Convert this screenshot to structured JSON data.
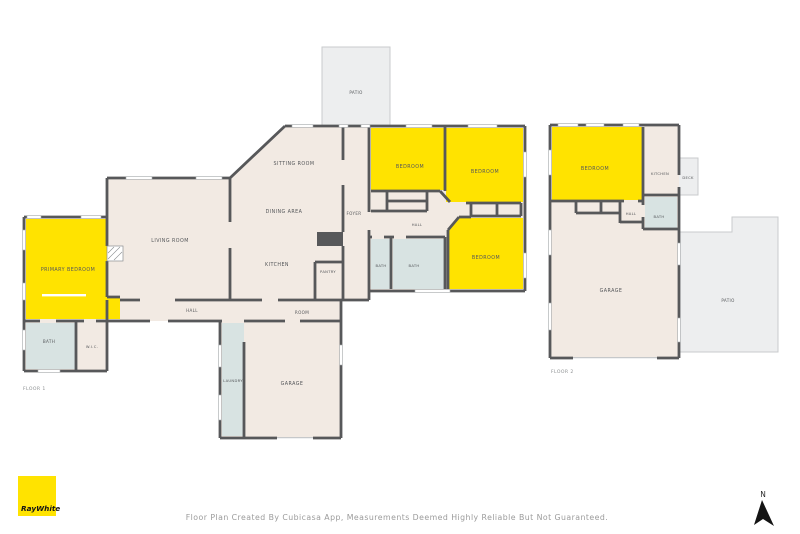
{
  "page": {
    "disclaimer": "Floor Plan Created By Cubicasa App, Measurements Deemed Highly Reliable But Not Guaranteed.",
    "north_label": "N"
  },
  "branding": {
    "logo_text": "RayWhite",
    "logo_color": "#FFE300"
  },
  "palette": {
    "wall": "#57585A",
    "room": "#F2EAE3",
    "wet_room": "#D8E3E2",
    "outdoor": "#EDEEEF",
    "highlight": "#FFE300",
    "label": "#55575A",
    "muted": "#9B9B9B"
  },
  "floor1": {
    "title": "FLOOR 1",
    "rooms": {
      "patio": "PATIO",
      "sitting_room": "SITTING ROOM",
      "dining_area": "DINING AREA",
      "living_room": "LIVING ROOM",
      "kitchen": "KITCHEN",
      "pantry": "PANTRY",
      "foyer": "FOYER",
      "primary_bedroom": "PRIMARY BEDROOM",
      "hall": "HALL",
      "room": "ROOM",
      "bath_master": "BATH",
      "wic": "W.I.C.",
      "laundry": "LAUNDRY",
      "garage": "GARAGE",
      "bedroom_a": "BEDROOM",
      "bedroom_b": "BEDROOM",
      "bedroom_c": "BEDROOM",
      "hall_bedrooms": "HALL",
      "bath_a": "BATH",
      "bath_b": "BATH"
    }
  },
  "floor2": {
    "title": "FLOOR 2",
    "rooms": {
      "bedroom": "BEDROOM",
      "kitchen": "KITCHEN",
      "deck": "DECK",
      "hall": "HALL",
      "bath": "BATH",
      "garage": "GARAGE",
      "patio": "PATIO"
    }
  }
}
